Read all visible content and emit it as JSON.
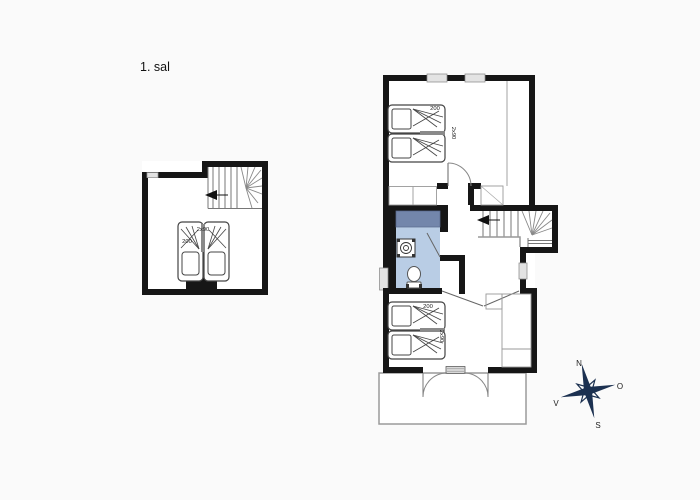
{
  "title": "1. sal",
  "plans": {
    "left": {
      "beds": {
        "width_label": "2x90",
        "length_label": "200"
      }
    },
    "right": {
      "bedroom_top": {
        "beds": {
          "length_label": "200",
          "width_label": "2x90"
        }
      },
      "bedroom_bottom": {
        "beds": {
          "length_label": "200",
          "width_label": "2x90"
        }
      }
    }
  },
  "compass": {
    "north": "N",
    "east": "O",
    "south": "S",
    "west": "V"
  },
  "colors": {
    "wall": "#161616",
    "bathroom_floor": "#b9cde5",
    "shower": "#7386ab",
    "compass": "#1b3050",
    "window": "#e3e3e3",
    "terrace_outline": "#9a9a9a"
  }
}
